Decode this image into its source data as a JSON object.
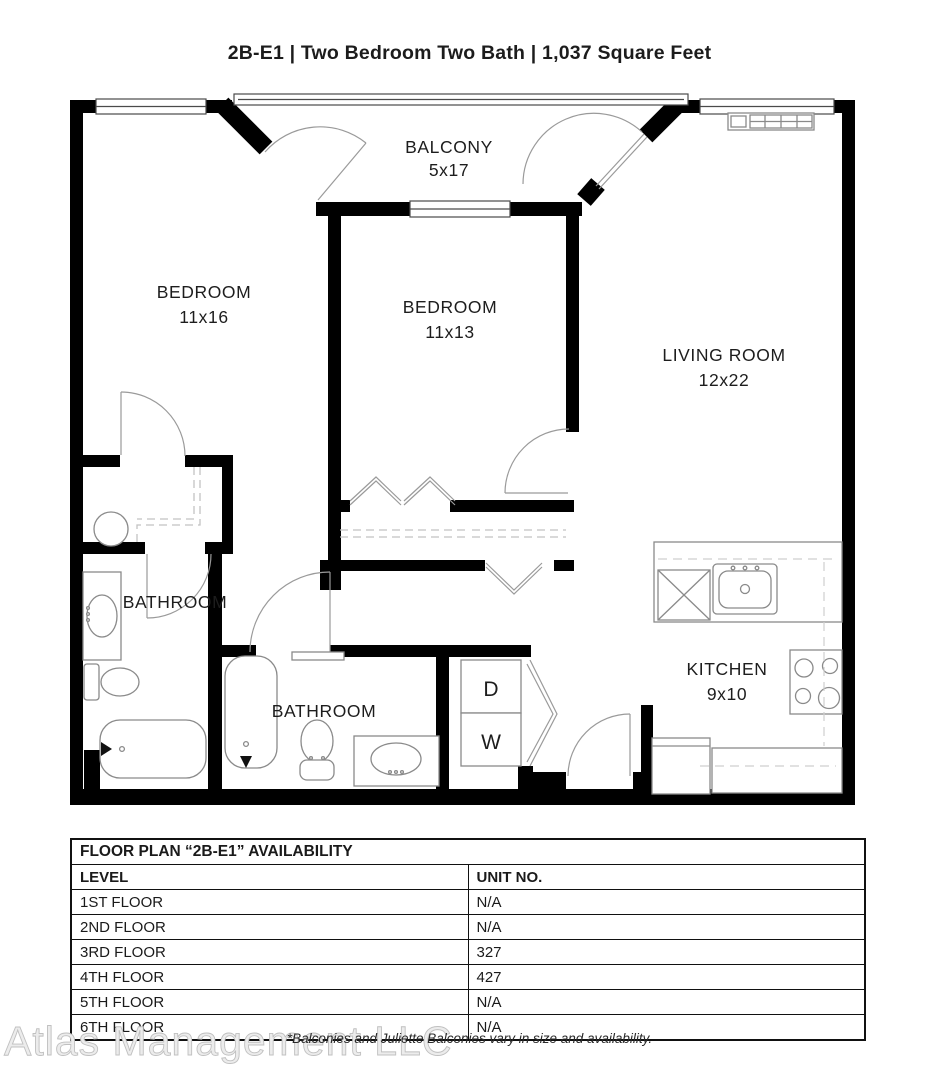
{
  "title": "2B-E1 | Two Bedroom Two Bath | 1,037 Square Feet",
  "plan": {
    "rooms": {
      "balcony": {
        "name": "BALCONY",
        "dims": "5x17"
      },
      "bedroom1": {
        "name": "BEDROOM",
        "dims": "11x16"
      },
      "bedroom2": {
        "name": "BEDROOM",
        "dims": "11x13"
      },
      "living_room": {
        "name": "LIVING ROOM",
        "dims": "12x22"
      },
      "bathroom1": {
        "name": "BATHROOM"
      },
      "bathroom2": {
        "name": "BATHROOM"
      },
      "kitchen": {
        "name": "KITCHEN",
        "dims": "9x10"
      },
      "dryer": {
        "label": "D"
      },
      "washer": {
        "label": "W"
      }
    },
    "wall_color": "#000000",
    "fixture_line_color": "#8a8a8a"
  },
  "availability_table": {
    "title": "FLOOR PLAN “2B-E1” AVAILABILITY",
    "columns": [
      "LEVEL",
      "UNIT NO."
    ],
    "rows": [
      {
        "level": "1ST FLOOR",
        "unit": "N/A"
      },
      {
        "level": "2ND FLOOR",
        "unit": "N/A"
      },
      {
        "level": "3RD FLOOR",
        "unit": "327"
      },
      {
        "level": "4TH FLOOR",
        "unit": "427"
      },
      {
        "level": "5TH FLOOR",
        "unit": "N/A"
      },
      {
        "level": "6TH FLOOR",
        "unit": "N/A"
      }
    ]
  },
  "footnote": "*Balconies and Juliette Balconies vary in size and availability.",
  "watermark": "Atlas Management LLC"
}
